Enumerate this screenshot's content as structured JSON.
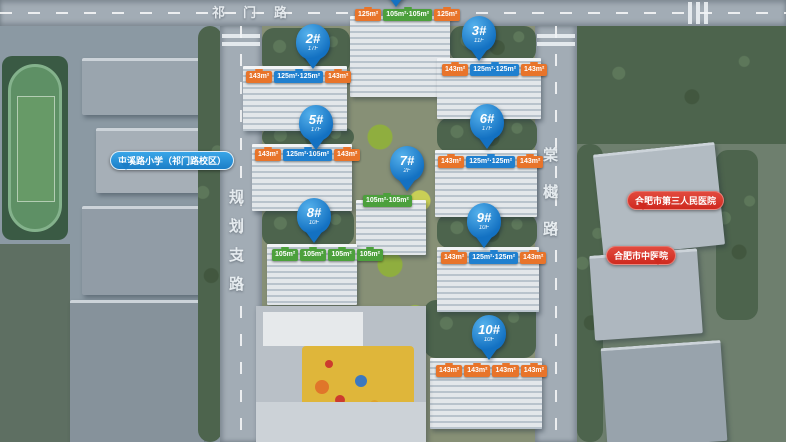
{
  "meta": {
    "view": "residential-masterplan-aerial"
  },
  "colors": {
    "pin_blue": "#1371c2",
    "tag_orange": "#e8742a",
    "tag_blue": "#2080cf",
    "tag_green": "#4ca03c",
    "bubble_blue": "#1b7ec7",
    "bubble_red": "#cf2a1f",
    "road_text": "#eef3f6"
  },
  "roads": [
    {
      "name": "qimen-road",
      "label": "祁门路",
      "orientation": "horizontal",
      "x": 212,
      "y": 2,
      "gap": 18
    },
    {
      "name": "planning-branch-road",
      "label": "规划支路",
      "orientation": "vertical",
      "x": 229,
      "y": 190,
      "gap": 14
    },
    {
      "name": "tangyue-road",
      "label": "棠樾路",
      "orientation": "vertical",
      "x": 543,
      "y": 148,
      "gap": 22
    }
  ],
  "pins": [
    {
      "id": "1#",
      "floors": "",
      "x": 396,
      "y": -38
    },
    {
      "id": "2#",
      "floors": "17F",
      "x": 313,
      "y": 24
    },
    {
      "id": "3#",
      "floors": "11F",
      "x": 479,
      "y": 16
    },
    {
      "id": "5#",
      "floors": "17F",
      "x": 316,
      "y": 105
    },
    {
      "id": "6#",
      "floors": "17F",
      "x": 487,
      "y": 104
    },
    {
      "id": "7#",
      "floors": "2F",
      "x": 407,
      "y": 146
    },
    {
      "id": "8#",
      "floors": "10F",
      "x": 314,
      "y": 198
    },
    {
      "id": "9#",
      "floors": "10F",
      "x": 484,
      "y": 203
    },
    {
      "id": "10#",
      "floors": "10F",
      "x": 489,
      "y": 315
    }
  ],
  "area_tag_groups": [
    {
      "building": "1#",
      "x": 354,
      "y": 9,
      "tags": [
        {
          "text": "125m²",
          "color": "orange"
        },
        {
          "text": "105m²·105m²",
          "color": "green"
        },
        {
          "text": "125m²",
          "color": "orange"
        }
      ]
    },
    {
      "building": "2#",
      "x": 245,
      "y": 71,
      "tags": [
        {
          "text": "143m²",
          "color": "orange"
        },
        {
          "text": "125m²·125m²",
          "color": "blue"
        },
        {
          "text": "143m²",
          "color": "orange"
        }
      ]
    },
    {
      "building": "3#",
      "x": 441,
      "y": 64,
      "tags": [
        {
          "text": "143m²",
          "color": "orange"
        },
        {
          "text": "125m²·125m²",
          "color": "blue"
        },
        {
          "text": "143m²",
          "color": "orange"
        }
      ]
    },
    {
      "building": "5#",
      "x": 254,
      "y": 149,
      "tags": [
        {
          "text": "143m²",
          "color": "orange"
        },
        {
          "text": "125m²·105m²",
          "color": "blue"
        },
        {
          "text": "143m²",
          "color": "orange"
        }
      ]
    },
    {
      "building": "6#",
      "x": 437,
      "y": 156,
      "tags": [
        {
          "text": "143m²",
          "color": "orange"
        },
        {
          "text": "125m²·125m²",
          "color": "blue"
        },
        {
          "text": "143m²",
          "color": "orange"
        }
      ]
    },
    {
      "building": "7#",
      "x": 362,
      "y": 195,
      "tags": [
        {
          "text": "105m²·105m²",
          "color": "green"
        }
      ]
    },
    {
      "building": "8#",
      "x": 271,
      "y": 249,
      "tags": [
        {
          "text": "105m²",
          "color": "green"
        },
        {
          "text": "105m²",
          "color": "green"
        },
        {
          "text": "105m²",
          "color": "green"
        },
        {
          "text": "105m²",
          "color": "green"
        }
      ]
    },
    {
      "building": "9#",
      "x": 440,
      "y": 252,
      "tags": [
        {
          "text": "143m²",
          "color": "orange"
        },
        {
          "text": "125m²·125m²",
          "color": "blue"
        },
        {
          "text": "143m²",
          "color": "orange"
        }
      ]
    },
    {
      "building": "10#",
      "x": 435,
      "y": 365,
      "tags": [
        {
          "text": "143m²",
          "color": "orange"
        },
        {
          "text": "143m²",
          "color": "orange"
        },
        {
          "text": "143m²",
          "color": "orange"
        },
        {
          "text": "143m²",
          "color": "orange"
        }
      ]
    }
  ],
  "poi_bubbles": [
    {
      "name": "school-bubble",
      "label": "屯溪路小学（祁门路校区）",
      "color": "blue",
      "tail": "left",
      "x": 110,
      "y": 151
    },
    {
      "name": "hospital-third-peoples-bubble",
      "label": "合肥市第三人民医院",
      "color": "red",
      "tail": "left",
      "x": 627,
      "y": 191
    },
    {
      "name": "hospital-tcm-bubble",
      "label": "合肥市中医院",
      "color": "red",
      "tail": "right",
      "x": 606,
      "y": 246
    }
  ]
}
